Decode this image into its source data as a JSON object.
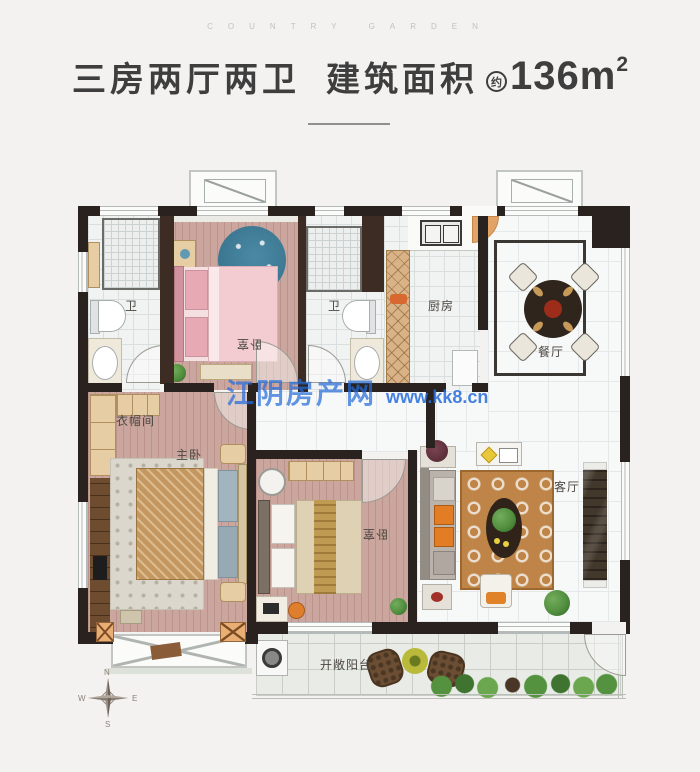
{
  "letterhead": "COUNTRY GARDEN",
  "title": {
    "layout": "三房两厅两卫",
    "area_label": "建筑面积",
    "approx": "约",
    "area_value": "136m",
    "area_sup": "2"
  },
  "watermark": {
    "name": "江阴房产网",
    "url": "www.kk8.cn"
  },
  "rooms": {
    "bath_left": "卫",
    "bedroom_top": "卧室",
    "bath_mid": "卫",
    "kitchen": "厨房",
    "dining": "餐厅",
    "cloakroom": "衣帽间",
    "master": "主卧",
    "bedroom_right": "卧室",
    "living": "客厅",
    "balcony": "开敞阳台"
  },
  "compass": {
    "n": "N",
    "e": "E",
    "s": "S",
    "w": "W"
  },
  "colors": {
    "wall": "#29221e",
    "watermark_blue": "#2b74dc",
    "entry_door_orange": "#e2a466",
    "wood_floor": "#cba69e",
    "title_text": "#3e3e3e"
  }
}
